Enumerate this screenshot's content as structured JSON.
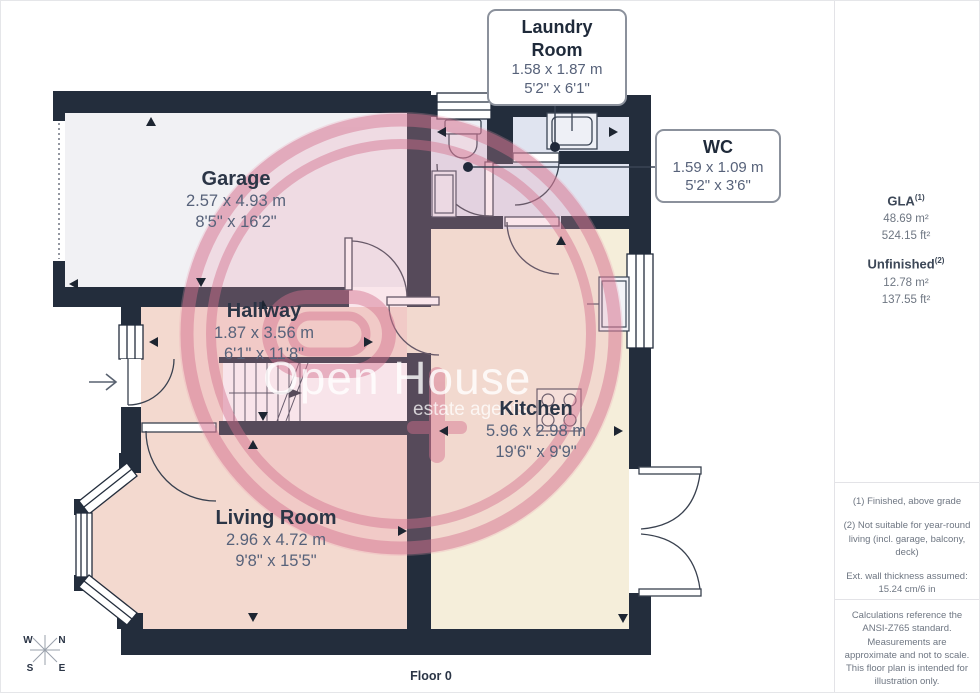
{
  "floorplan": {
    "floor_label": "Floor 0",
    "rooms": {
      "garage": {
        "name": "Garage",
        "metric": "2.57 x 4.93 m",
        "imperial": "8'5\" x 16'2\""
      },
      "hallway": {
        "name": "Hallway",
        "metric": "1.87 x 3.56 m",
        "imperial": "6'1\" x 11'8\""
      },
      "kitchen": {
        "name": "Kitchen",
        "metric": "5.96 x 2.98 m",
        "imperial": "19'6\" x 9'9\""
      },
      "living_room": {
        "name": "Living Room",
        "metric": "2.96 x 4.72 m",
        "imperial": "9'8\" x 15'5\""
      }
    },
    "callouts": {
      "laundry_room": {
        "name": "Laundry Room",
        "metric": "1.58 x 1.87 m",
        "imperial": "5'2\" x 6'1\""
      },
      "wc": {
        "name": "WC",
        "metric": "1.59 x 1.09 m",
        "imperial": "5'2\" x 3'6\""
      }
    },
    "compass": {
      "n": "N",
      "s": "S",
      "e": "E",
      "w": "W"
    },
    "colors": {
      "wall": "#232d3c",
      "hallway_living_floor": "#f3d9cf",
      "kitchen_floor": "#f5eeda",
      "laundry_wc_floor": "#e0e4f0",
      "garage_floor": "#f1f1f4",
      "watermark_pink": "#d4718e"
    }
  },
  "watermark": {
    "title": "Open House",
    "subtitle": "estate agents"
  },
  "sidebar": {
    "gla": {
      "label": "GLA",
      "sup": "(1)",
      "m2": "48.69 m²",
      "ft2": "524.15 ft²"
    },
    "unfinished": {
      "label": "Unfinished",
      "sup": "(2)",
      "m2": "12.78 m²",
      "ft2": "137.55 ft²"
    },
    "footnotes": [
      "(1) Finished, above grade",
      "(2) Not suitable for year-round living (incl. garage, balcony, deck)",
      "Ext. wall thickness assumed: 15.24 cm/6 in"
    ],
    "disclaimer": "Calculations reference the ANSI-Z765 standard. Measurements are approximate and not to scale. This floor plan is intended for illustration only.",
    "brand": {
      "name": "GIRAFFE",
      "bold": "360"
    }
  }
}
